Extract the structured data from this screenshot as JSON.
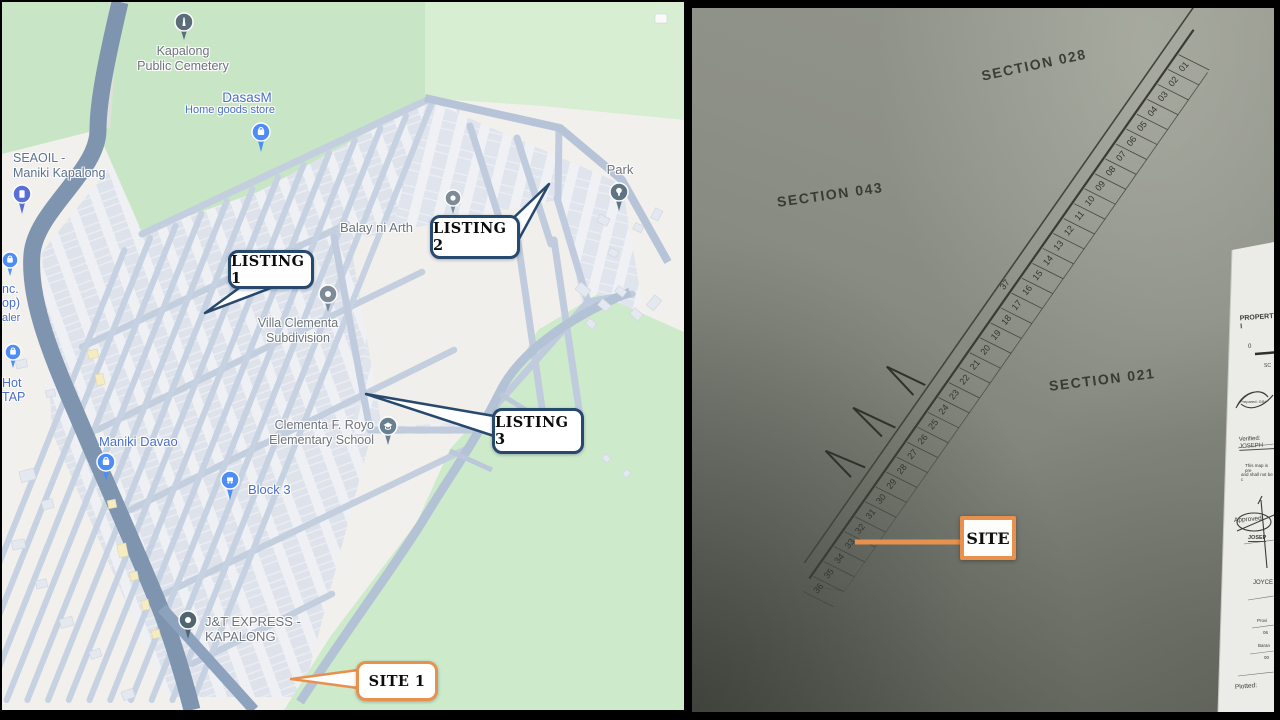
{
  "left_panel": {
    "callouts": {
      "listing1": "LISTING 1",
      "listing2": "LISTING 2",
      "listing3": "LISTING 3",
      "site1": "SITE 1"
    },
    "labels": {
      "cemetery": "Kapalong\nPublic Cemetery",
      "dasasm": "DasasM",
      "dasasm_sub": "Home goods store",
      "seaoil": "SEAOIL -\nManiki Kapalong",
      "partial_inc": "nc.",
      "partial_op": "op)",
      "partial_aler": "aler",
      "partial_hot": "Hot",
      "partial_tap": "TAP",
      "maniki_davao": "Maniki Davao",
      "villa": "Villa Clementa\nSubdivision",
      "balay": "Balay ni Arth",
      "park": "Park",
      "block3": "Block 3",
      "school": "Clementa F. Royo\nElementary School",
      "jnt": "J&T EXPRESS -\nKAPALONG"
    },
    "colors": {
      "callout_border": "#27496d",
      "site_border": "#e8914e",
      "label_blue": "#4a6fc8",
      "label_gray": "#6d737b"
    }
  },
  "right_panel": {
    "sections": {
      "s028": "SECTION 028",
      "s043": "SECTION 043",
      "s021": "SECTION 021"
    },
    "lot_numbers": [
      "01",
      "02",
      "03",
      "04",
      "05",
      "06",
      "07",
      "08",
      "09",
      "10",
      "11",
      "12",
      "13",
      "14",
      "15",
      "16",
      "17",
      "18",
      "19",
      "20",
      "21",
      "22",
      "23",
      "24",
      "25",
      "26",
      "27",
      "28",
      "29",
      "30",
      "31",
      "32",
      "33",
      "34",
      "35",
      "36"
    ],
    "lot_37": "37",
    "site_label": "SITE",
    "property_block": {
      "title": "PROPERTY I",
      "scale_zero": "0",
      "scale_sc": "SC",
      "prepared": "Prepared: GIN",
      "verified": "Verified: JOSEPH",
      "note1": "This map is pre",
      "note2": "and shall not be c",
      "approved": "Approved:",
      "approved_name": "JOSEP",
      "name2": "JOYCE",
      "prov": "Provi",
      "prov_no": "06",
      "brgy": "Baran",
      "brgy_no": "00",
      "plotted": "Plotted:"
    }
  }
}
